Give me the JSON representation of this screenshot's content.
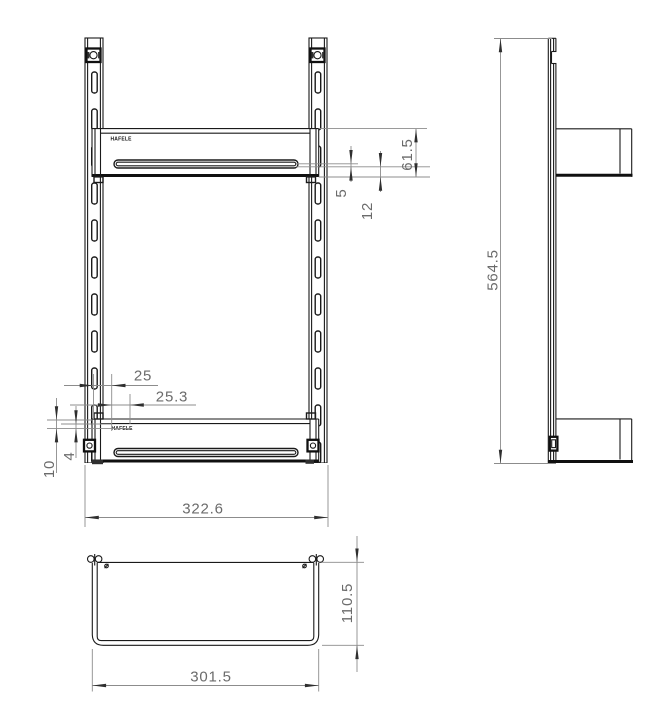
{
  "brand": "HAFELE",
  "colors": {
    "line": "#1a1a1a",
    "dim_line": "#8c8c8c",
    "dim_text": "#6b6b6b",
    "background": "#ffffff"
  },
  "dims": {
    "d61_5": "61.5",
    "d5": "5",
    "d12": "12",
    "d25": "25",
    "d25_3": "25.3",
    "d10": "10",
    "d4": "4",
    "d322_6": "322.6",
    "d564_5": "564.5",
    "d110_5": "110.5",
    "d301_5": "301.5"
  }
}
